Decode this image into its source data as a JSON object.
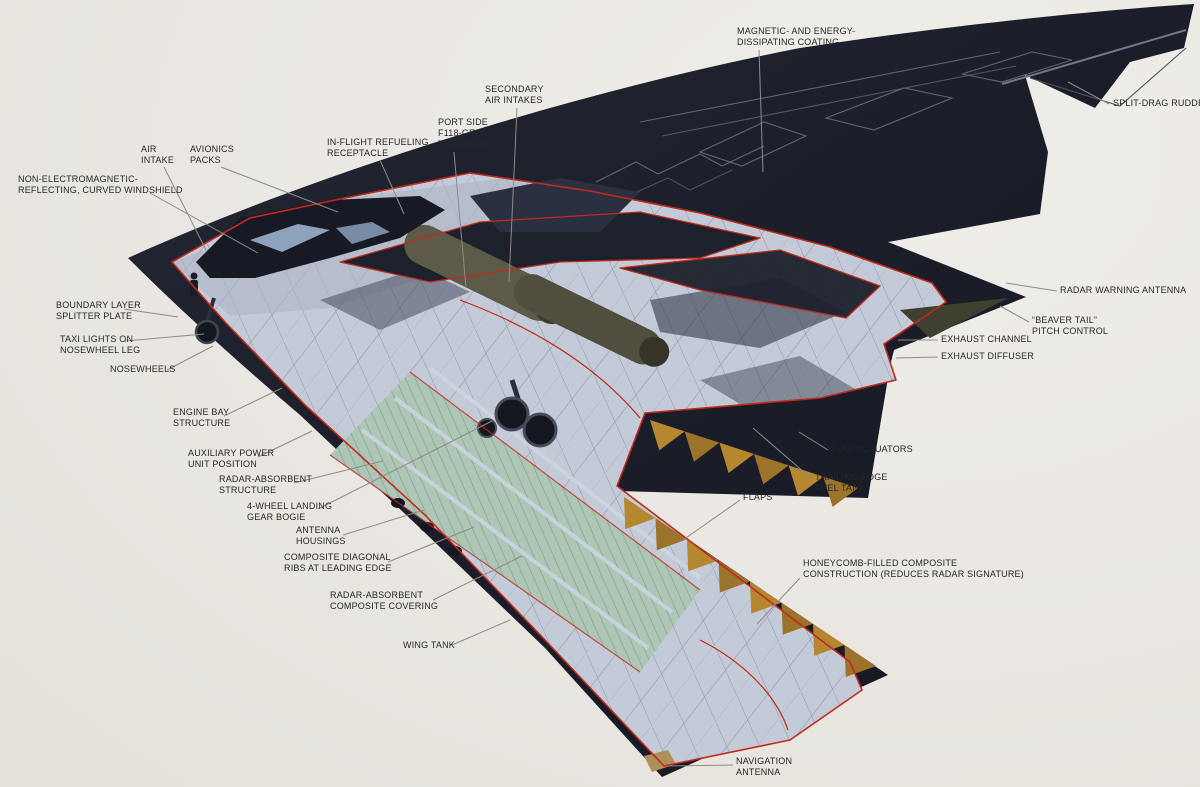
{
  "diagram": {
    "subject": "Northrop B-2 stealth bomber cutaway illustration",
    "type": "annotated-cutaway",
    "colors": {
      "background": "#eae7e2",
      "airframe_dark": "#1c1f2a",
      "cutaway_light": "#c4cbd8",
      "cut_line_red": "#c3291c",
      "wing_tank_green": "#aec6b6",
      "honeycomb_ochre": "#b5872f",
      "leader_line": "#8e8b84",
      "label_text": "#262626"
    },
    "callouts": [
      {
        "id": "magnetic-coating",
        "lines": [
          "MAGNETIC- AND ENERGY-",
          "DISSIPATING COATING"
        ],
        "x": 737,
        "y": 26,
        "leader": [
          [
            759,
            50
          ],
          [
            763,
            172
          ]
        ]
      },
      {
        "id": "split-drag-rudder",
        "lines": [
          "SPLIT-DRAG RUDDER"
        ],
        "x": 1113,
        "y": 98,
        "leader": [
          [
            1109,
            104
          ],
          [
            1068,
            82
          ]
        ]
      },
      {
        "id": "secondary-air-intakes",
        "lines": [
          "SECONDARY",
          "AIR INTAKES"
        ],
        "x": 485,
        "y": 84,
        "leader": [
          [
            517,
            108
          ],
          [
            509,
            282
          ]
        ]
      },
      {
        "id": "port-turbofans",
        "lines": [
          "PORT SIDE",
          "F118-GE-100",
          "TURBOFANS"
        ],
        "x": 438,
        "y": 117,
        "leader": [
          [
            454,
            152
          ],
          [
            466,
            288
          ]
        ]
      },
      {
        "id": "refueling-receptacle",
        "lines": [
          "IN-FLIGHT REFUELING",
          "RECEPTACLE"
        ],
        "x": 327,
        "y": 137,
        "leader": [
          [
            380,
            160
          ],
          [
            404,
            214
          ]
        ]
      },
      {
        "id": "air-intake",
        "lines": [
          "AIR",
          "INTAKE"
        ],
        "x": 141,
        "y": 144,
        "leader": [
          [
            164,
            167
          ],
          [
            206,
            250
          ]
        ]
      },
      {
        "id": "avionics-packs",
        "lines": [
          "AVIONICS",
          "PACKS"
        ],
        "x": 190,
        "y": 144,
        "leader": [
          [
            221,
            167
          ],
          [
            338,
            212
          ]
        ]
      },
      {
        "id": "windshield",
        "lines": [
          "NON-ELECTROMAGNETIC-",
          "REFLECTING, CURVED WINDSHIELD"
        ],
        "x": 18,
        "y": 174,
        "leader": [
          [
            150,
            193
          ],
          [
            258,
            253
          ]
        ]
      },
      {
        "id": "boundary-layer-plate",
        "lines": [
          "BOUNDARY LAYER",
          "SPLITTER PLATE"
        ],
        "x": 56,
        "y": 300,
        "leader": [
          [
            124,
            309
          ],
          [
            178,
            317
          ]
        ]
      },
      {
        "id": "taxi-lights",
        "lines": [
          "TAXI LIGHTS ON",
          "NOSEWHEEL LEG"
        ],
        "x": 60,
        "y": 334,
        "leader": [
          [
            125,
            341
          ],
          [
            204,
            334
          ]
        ]
      },
      {
        "id": "nosewheels",
        "lines": [
          "NOSEWHEELS"
        ],
        "x": 110,
        "y": 364,
        "leader": [
          [
            167,
            370
          ],
          [
            213,
            346
          ]
        ]
      },
      {
        "id": "engine-bay-structure",
        "lines": [
          "ENGINE BAY",
          "STRUCTURE"
        ],
        "x": 173,
        "y": 407,
        "leader": [
          [
            224,
            416
          ],
          [
            282,
            388
          ]
        ]
      },
      {
        "id": "apu-position",
        "lines": [
          "AUXILIARY POWER",
          "UNIT POSITION"
        ],
        "x": 188,
        "y": 448,
        "leader": [
          [
            258,
            457
          ],
          [
            312,
            431
          ]
        ]
      },
      {
        "id": "radar-absorbent-structure",
        "lines": [
          "RADAR-ABSORBENT",
          "STRUCTURE"
        ],
        "x": 219,
        "y": 474,
        "leader": [
          [
            294,
            483
          ],
          [
            383,
            461
          ]
        ]
      },
      {
        "id": "landing-gear-bogie",
        "lines": [
          "4-WHEEL LANDING",
          "GEAR BOGIE"
        ],
        "x": 247,
        "y": 501,
        "leader": [
          [
            318,
            509
          ],
          [
            492,
            421
          ]
        ]
      },
      {
        "id": "antenna-housings",
        "lines": [
          "ANTENNA",
          "HOUSINGS"
        ],
        "x": 296,
        "y": 525,
        "leader": [
          [
            343,
            535
          ],
          [
            424,
            510
          ]
        ]
      },
      {
        "id": "composite-ribs",
        "lines": [
          "COMPOSITE DIAGONAL",
          "RIBS AT LEADING EDGE"
        ],
        "x": 284,
        "y": 552,
        "leader": [
          [
            388,
            562
          ],
          [
            474,
            527
          ]
        ]
      },
      {
        "id": "composite-covering",
        "lines": [
          "RADAR-ABSORBENT",
          "COMPOSITE COVERING"
        ],
        "x": 330,
        "y": 590,
        "leader": [
          [
            433,
            600
          ],
          [
            522,
            556
          ]
        ]
      },
      {
        "id": "wing-tank",
        "lines": [
          "WING TANK"
        ],
        "x": 403,
        "y": 640,
        "leader": [
          [
            452,
            645
          ],
          [
            510,
            620
          ]
        ]
      },
      {
        "id": "radar-warning-antenna",
        "lines": [
          "RADAR WARNING ANTENNA"
        ],
        "x": 1060,
        "y": 285,
        "leader": [
          [
            1057,
            291
          ],
          [
            1006,
            283
          ]
        ]
      },
      {
        "id": "beaver-tail",
        "lines": [
          "“BEAVER TAIL”",
          "PITCH CONTROL"
        ],
        "x": 1032,
        "y": 315,
        "leader": [
          [
            1029,
            322
          ],
          [
            1000,
            306
          ]
        ]
      },
      {
        "id": "exhaust-channel",
        "lines": [
          "EXHAUST CHANNEL"
        ],
        "x": 941,
        "y": 334,
        "leader": [
          [
            938,
            340
          ],
          [
            898,
            340
          ]
        ]
      },
      {
        "id": "exhaust-diffuser",
        "lines": [
          "EXHAUST DIFFUSER"
        ],
        "x": 941,
        "y": 351,
        "leader": [
          [
            938,
            357
          ],
          [
            896,
            358
          ]
        ]
      },
      {
        "id": "flap-actuators",
        "lines": [
          "FLAP ACTUATORS"
        ],
        "x": 831,
        "y": 444,
        "leader": [
          [
            828,
            450
          ],
          [
            799,
            432
          ]
        ]
      },
      {
        "id": "trailing-edge-fuel-tank",
        "lines": [
          "TRAILING-EDGE",
          "FUEL TANK"
        ],
        "x": 815,
        "y": 472,
        "leader": [
          [
            812,
            479
          ],
          [
            753,
            428
          ]
        ]
      },
      {
        "id": "flaps",
        "lines": [
          "FLAPS"
        ],
        "x": 743,
        "y": 492,
        "leader": [
          [
            740,
            500
          ],
          [
            683,
            540
          ]
        ]
      },
      {
        "id": "honeycomb-construction",
        "lines": [
          "HONEYCOMB-FILLED COMPOSITE",
          "CONSTRUCTION (REDUCES RADAR SIGNATURE)"
        ],
        "x": 803,
        "y": 558,
        "leader": [
          [
            800,
            578
          ],
          [
            757,
            624
          ]
        ]
      },
      {
        "id": "navigation-antenna",
        "lines": [
          "NAVIGATION",
          "ANTENNA"
        ],
        "x": 736,
        "y": 756,
        "leader": [
          [
            733,
            765
          ],
          [
            668,
            766
          ]
        ]
      }
    ]
  }
}
